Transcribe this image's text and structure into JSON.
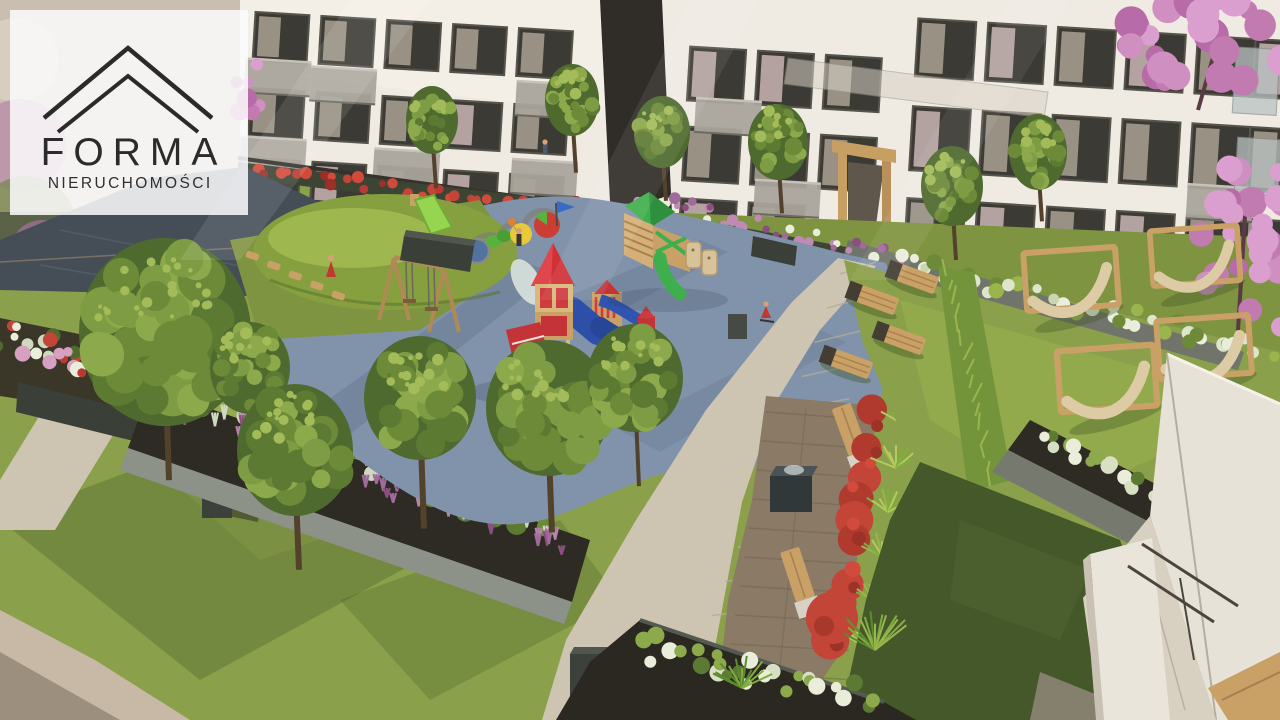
{
  "page": {
    "type": "real-estate-listing-visualization",
    "subject": "3D rendering of a residential courtyard with playground and garden"
  },
  "logo": {
    "brand": "FORMA",
    "subtitle": "NIERUCHOMOŚCI",
    "icon": "roof-chevrons-icon",
    "text_color": "#2b2b2b",
    "background": "rgba(252,252,253,0.86)"
  },
  "palette": {
    "facade": "#efeae2",
    "window_dark": "#3b3a34",
    "brick_dark": "#302c28",
    "balcony_gray": "#a9a59b",
    "playground_blue": "#8193ab",
    "grass": "#8aa04a",
    "grass_shadow": "#44582a",
    "path_light": "#cdc5b2",
    "patio_brown": "#8a7a66",
    "planter_dark": "#3c413c",
    "wood": "#c9a065",
    "hammock_canvas": "#ddcba6",
    "slide_green": "#3faf4e",
    "castle_red": "#d03036",
    "slide_blue": "#2f55b0",
    "flower_red": "#c24537",
    "flower_white": "#e9edda",
    "flower_purple": "#a06b9a",
    "blossom_pink": "#cf8fc0"
  },
  "scene_objects": [
    "apartment-buildings",
    "entrance-portal",
    "glass-canopy",
    "blue-safety-surface",
    "castle-play-structure",
    "wooden-fort",
    "hill-slide",
    "swing-set",
    "hopscotch-graphic",
    "grass-mound",
    "sun-loungers",
    "hammock-frames",
    "ornamental-grass-hedge",
    "patio-fountain",
    "patio-benches",
    "flower-beds",
    "heather-bed",
    "paved-paths",
    "trash-bin",
    "planter-boxes",
    "blossom-trees",
    "balcony-corner",
    "children-figures"
  ],
  "counts": {
    "sun_loungers": 4,
    "hammocks": 4,
    "patio_benches": 2,
    "playground_structures": 3
  }
}
